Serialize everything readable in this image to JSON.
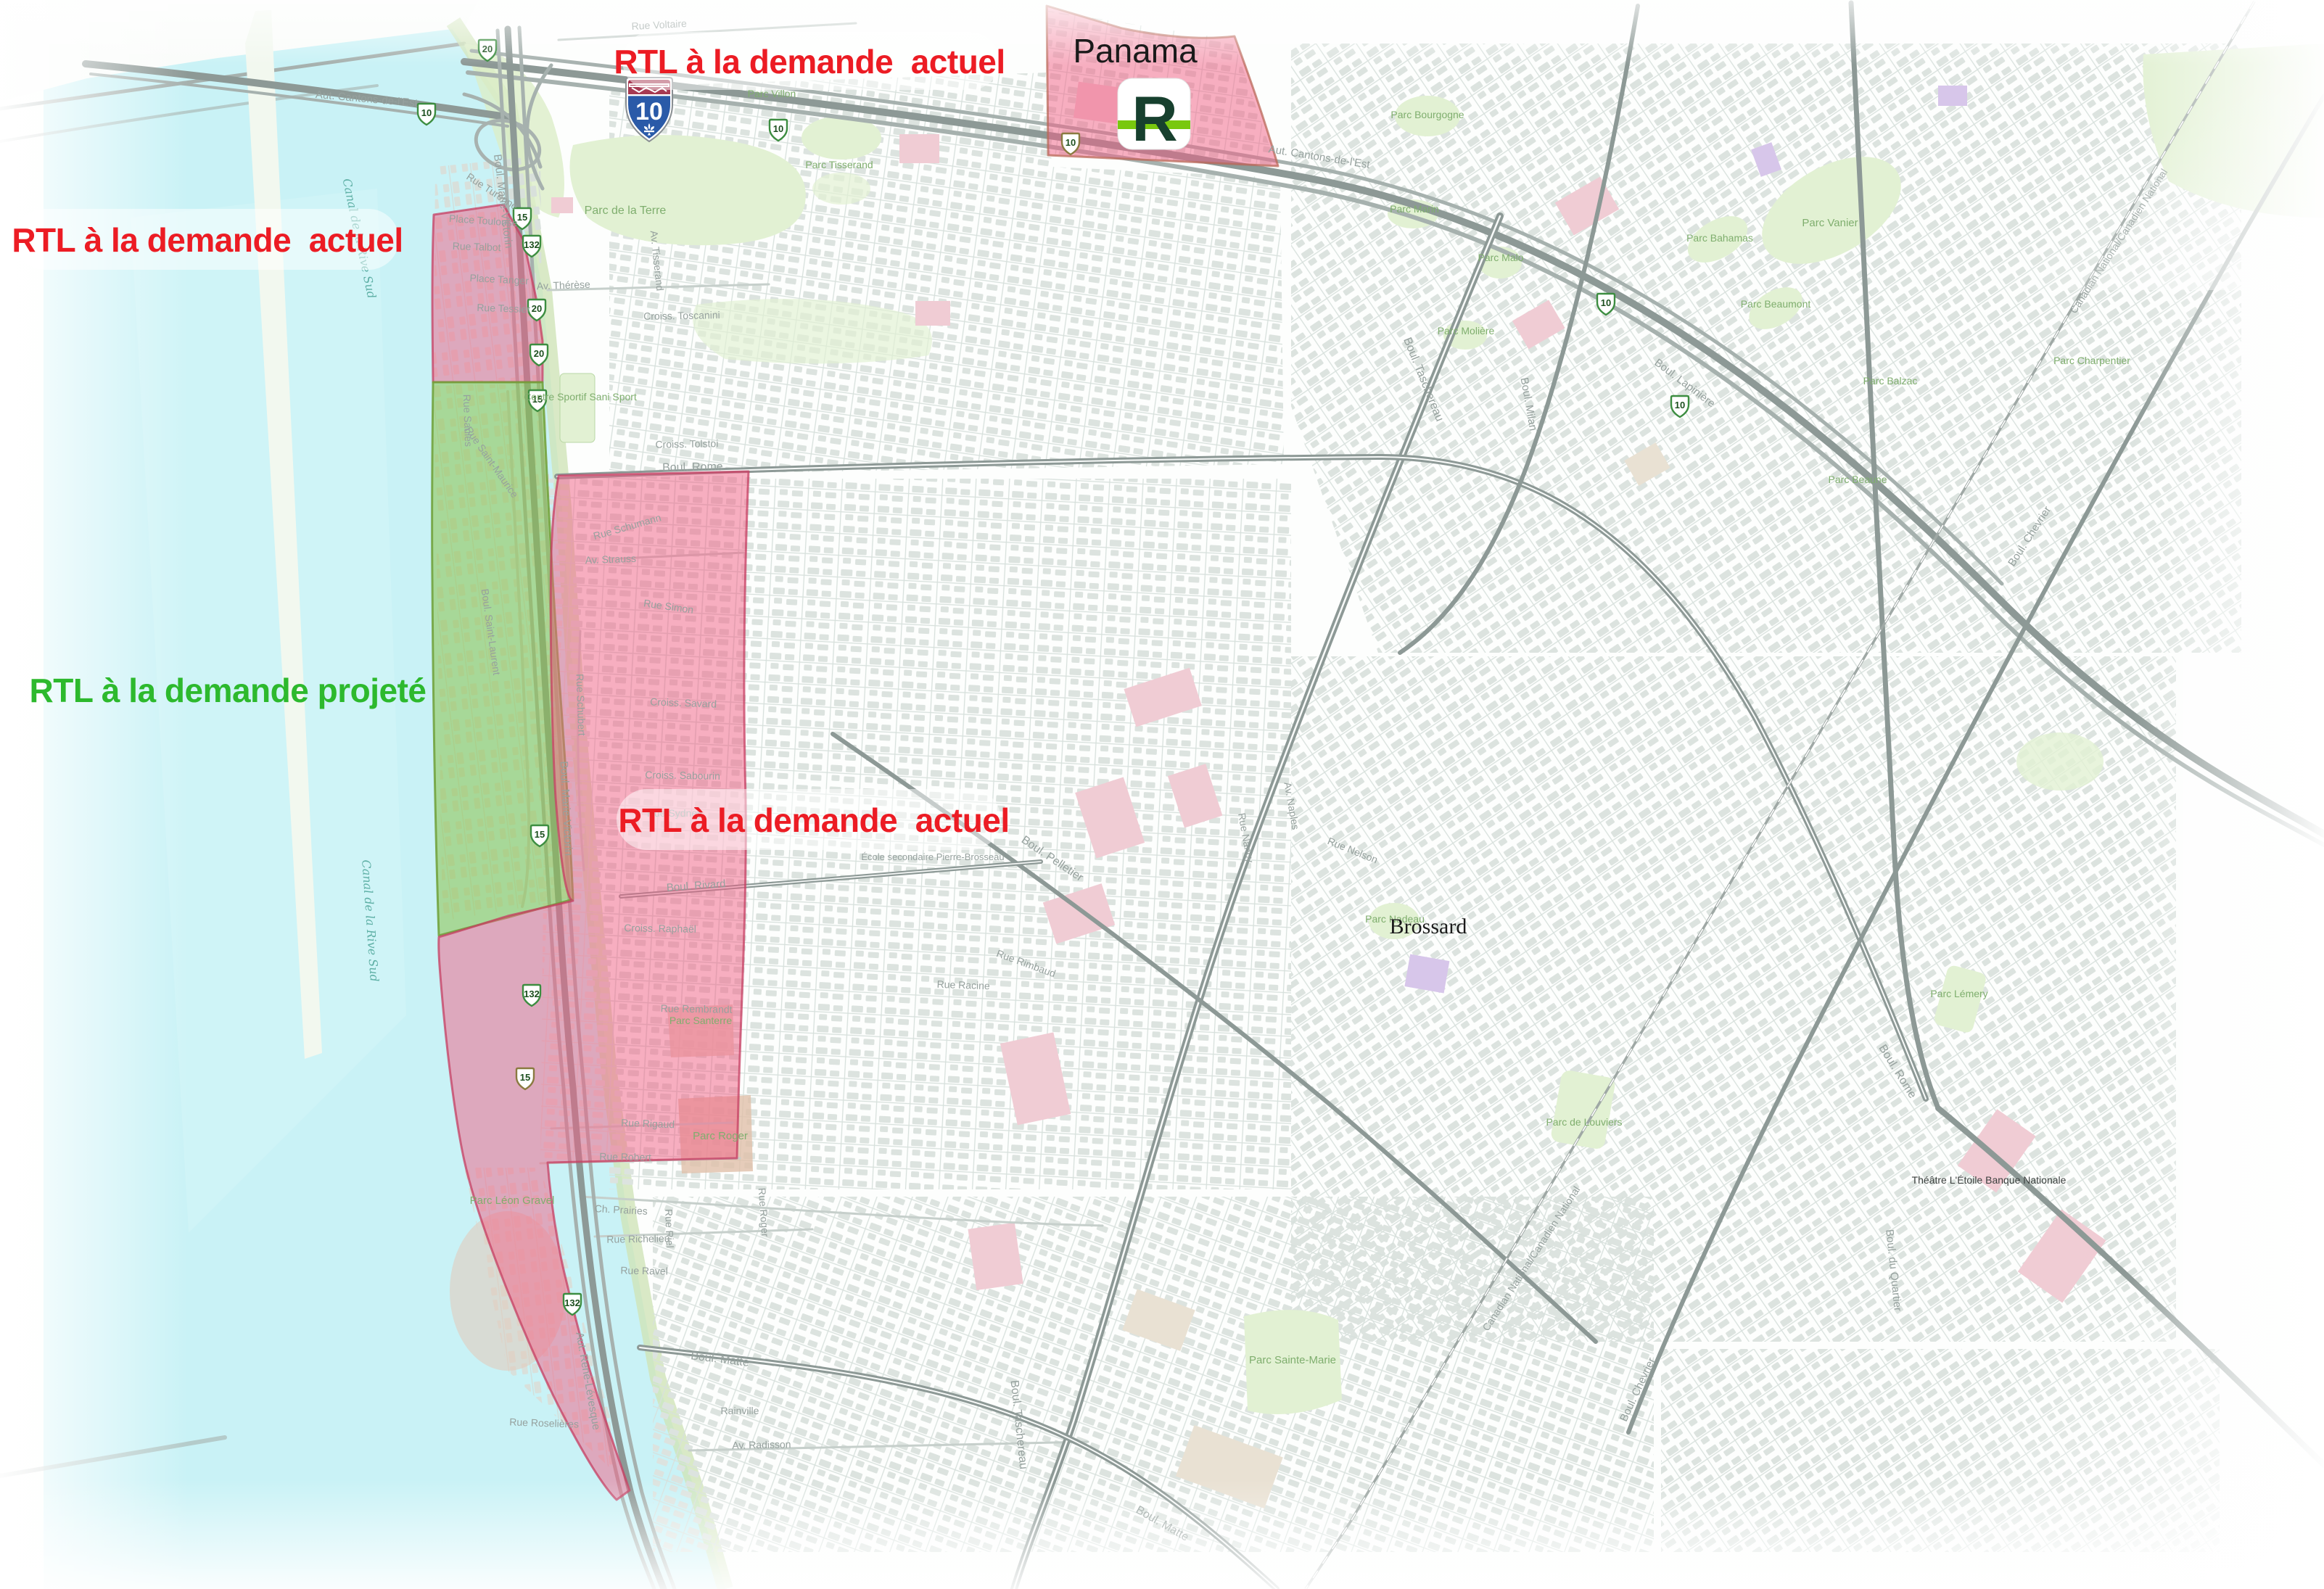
{
  "overlay_labels": {
    "actuel_top": "RTL à la demande  actuel",
    "actuel_left": "RTL à la demande  actuel",
    "actuel_center": "RTL à la demande  actuel",
    "projete": "RTL à la demande projeté"
  },
  "station": {
    "name": "Panama",
    "logo_letter": "R"
  },
  "city": "Brossard",
  "route_shields": {
    "autoroute_major": "10",
    "minor": [
      "20",
      "10",
      "15",
      "132",
      "20",
      "20",
      "15",
      "10",
      "15",
      "132",
      "15",
      "132",
      "10",
      "10",
      "10"
    ]
  },
  "colors": {
    "label_actuel": "#ec1c24",
    "label_projete": "#2db92d",
    "zone_actuel_fill": "#f25e84",
    "zone_actuel_border": "#c53e61",
    "zone_projete_fill": "#8bc34a",
    "zone_projete_border": "#6ea037",
    "water": "#c9f2f6",
    "park_green": "#e2f1d3",
    "road_gray": "#8d9996",
    "building_gray": "#dce3df",
    "rem_dark_green": "#17402e",
    "rem_light_green": "#79c80e",
    "autoroute_shield_blue": "#2a5aa8",
    "autoroute_shield_red": "#a73a52",
    "route_shield_green": "#3c8d40"
  },
  "streets": [
    "Aut. Cantons-de-l'Est",
    "Aut. Cantons-de-l'Est",
    "Boul. Marie-Victorin",
    "Boul. Marie-Victorin",
    "Boul. Taschereau",
    "Boul. Taschereau",
    "Boul. Rome",
    "Boul. Rome",
    "Boul. Matte",
    "Boul. Matte",
    "Boul. Pelletier",
    "Boul. Rivard",
    "Aut. René-Lévesque",
    "Canadian National/Canadien National",
    "Canadian National/Canadien National",
    "Boul. Lapinière",
    "Boul. Milan",
    "Boul. Chevrier",
    "Boul. Chevrier",
    "Boul. du Quartier",
    "Rue Rigaud",
    "Rue Robert",
    "Croiss. Savard",
    "Croiss. Sabourin",
    "Rue Sydney",
    "Croiss. Raphaël",
    "Rue Rembrandt",
    "Av. Strauss",
    "Rue Simon",
    "Rue Schumann",
    "Rue Schubert",
    "Place Toulouse",
    "Rue Talbot",
    "Place Tanger",
    "Rue Tessier",
    "Rue Saules",
    "Rue Saint-Maurice",
    "Av. Thérèse",
    "Croiss. Toscanini",
    "Croiss. Tolstoi",
    "Av. Tisserand",
    "Boul. Saint-Laurent",
    "Ch. Prairies",
    "Rue Richelieu",
    "Rue Ravel",
    "Rue Roselières",
    "Av. Radisson",
    "Rainville",
    "Rue Riel",
    "Rue Roger",
    "Rue Nancy",
    "Av. Naples",
    "Rue Nelson",
    "Rue Rimbaud",
    "Rue Racine",
    "Rue Voltaire",
    "Rue Turenne"
  ],
  "parks": [
    "Parc de la Terre",
    "Parc Sainte-Marie",
    "Parc Vanier",
    "Parc Bourgogne",
    "Parc Marin",
    "Parc Malo",
    "Parc Bahamas",
    "Parc Beaumont",
    "Parc Molière",
    "Parc Nadeau",
    "Parc de Louviers",
    "Parc Lémery",
    "Parc Léon Gravel",
    "Parc Roger",
    "Parc Santerre",
    "Parc Charpentier",
    "Parc Balzac",
    "Parc Beaune",
    "Centre Sportif Sani Sport",
    "Parc Villon",
    "Parc Tisserand"
  ],
  "pois": [
    "Brossard",
    "Théâtre L'Étoile Banque Nationale",
    "École secondaire Pierre-Brosseau"
  ],
  "water_labels": [
    "Canal de la Rive Sud",
    "Canal de la Rive Sud"
  ]
}
